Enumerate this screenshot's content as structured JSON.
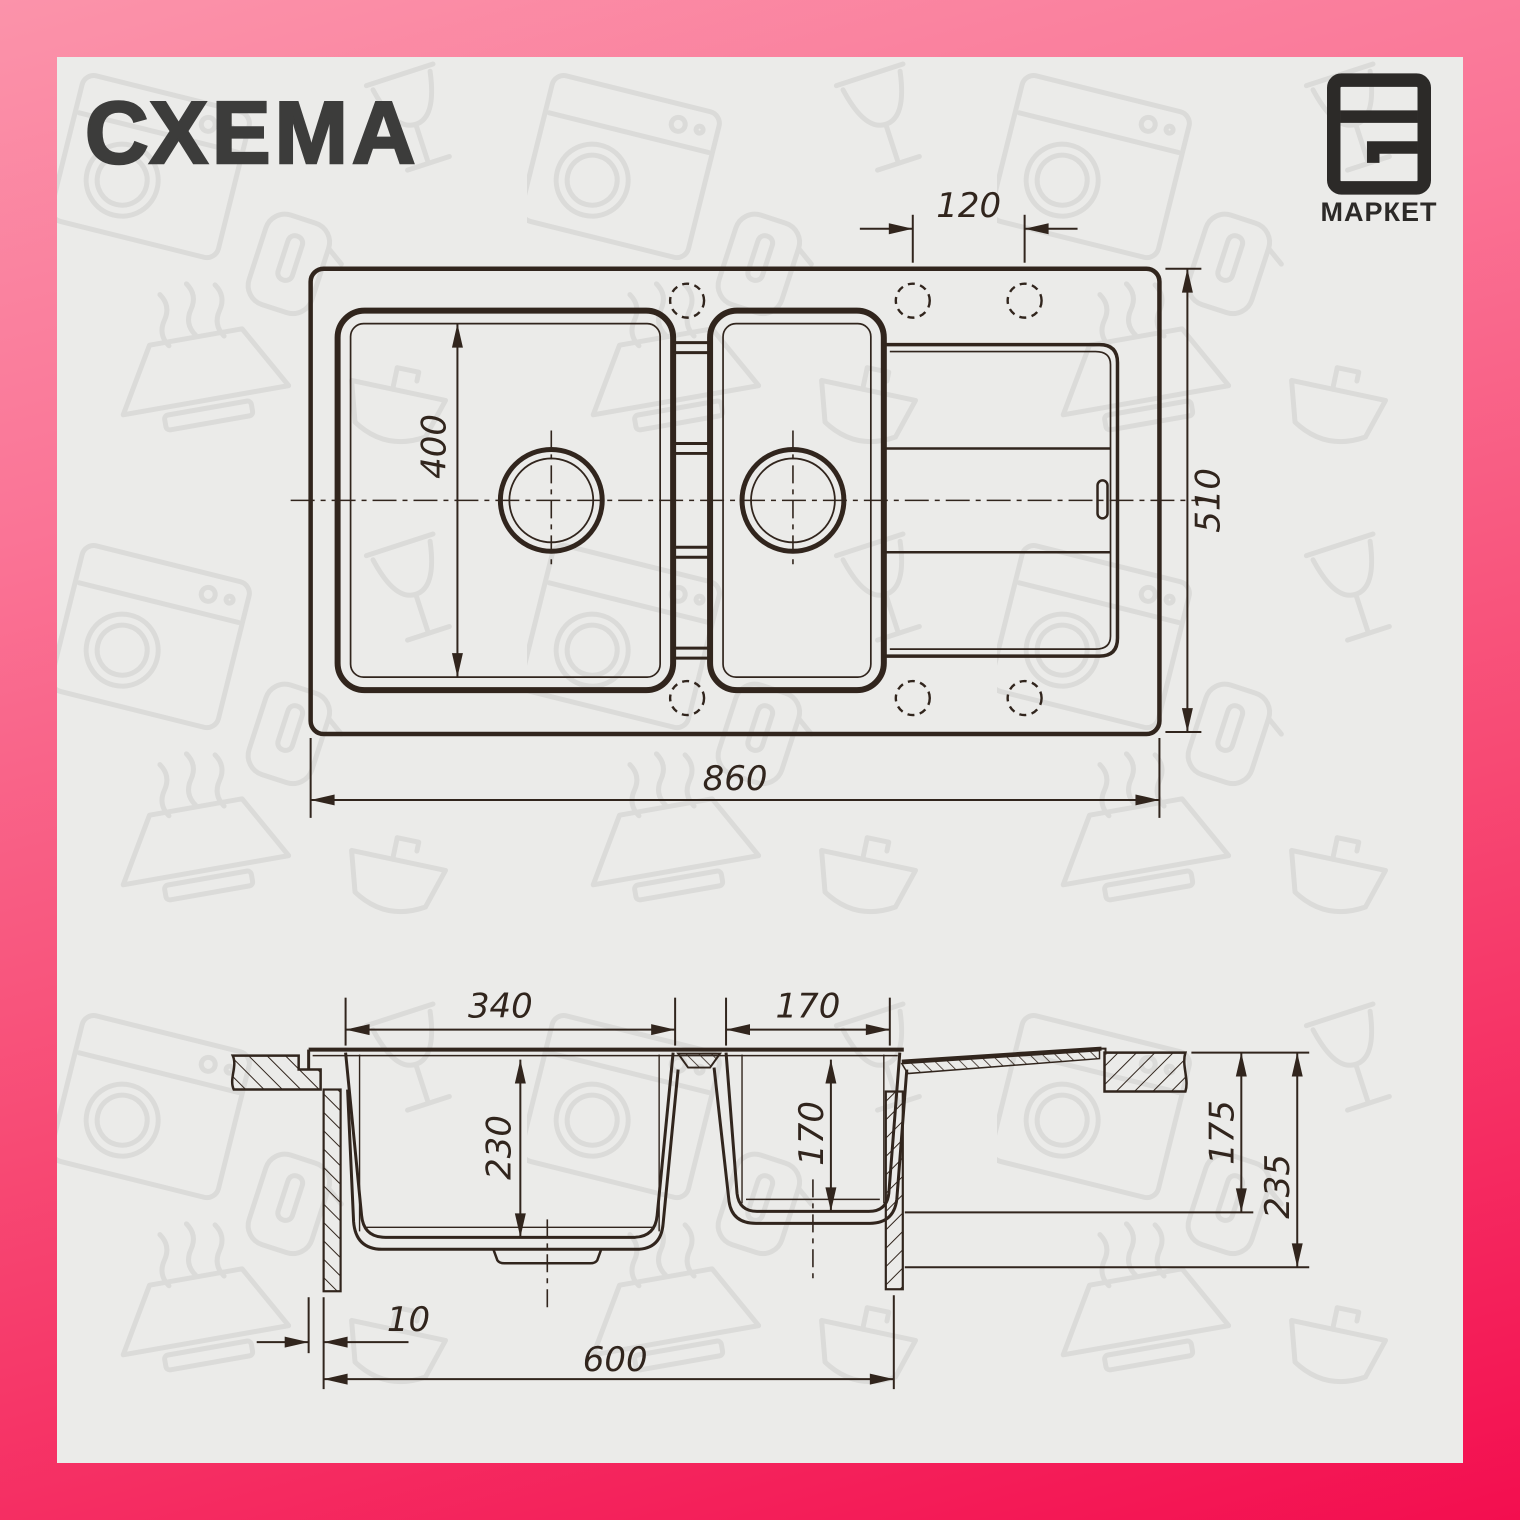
{
  "title": "СХЕМА",
  "brand": {
    "name": "МАРКЕТ",
    "icon": "f2-frame-logo"
  },
  "colors": {
    "frame_start": "#fb93aa",
    "frame_end": "#f30e4f",
    "paper": "#ebebe9",
    "ink": "#31251d",
    "title_ink": "#3c3c3b",
    "logo_ink": "#2c2a28",
    "pattern_ink": "#d8d8d6"
  },
  "background_icons": [
    "washing-machine",
    "wine-glass",
    "range-hood",
    "kitchen-sink",
    "kettle"
  ],
  "views": {
    "top": {
      "dims": {
        "hole_spacing": "120",
        "bowl_length": "400",
        "overall_depth": "510",
        "overall_width": "860"
      }
    },
    "section": {
      "dims": {
        "main_bowl_width": "340",
        "small_bowl_width": "170",
        "main_bowl_depth": "230",
        "small_bowl_depth": "170",
        "under_top_height": "175",
        "overall_height": "235",
        "edge_offset": "10",
        "cabinet_width": "600"
      }
    }
  }
}
